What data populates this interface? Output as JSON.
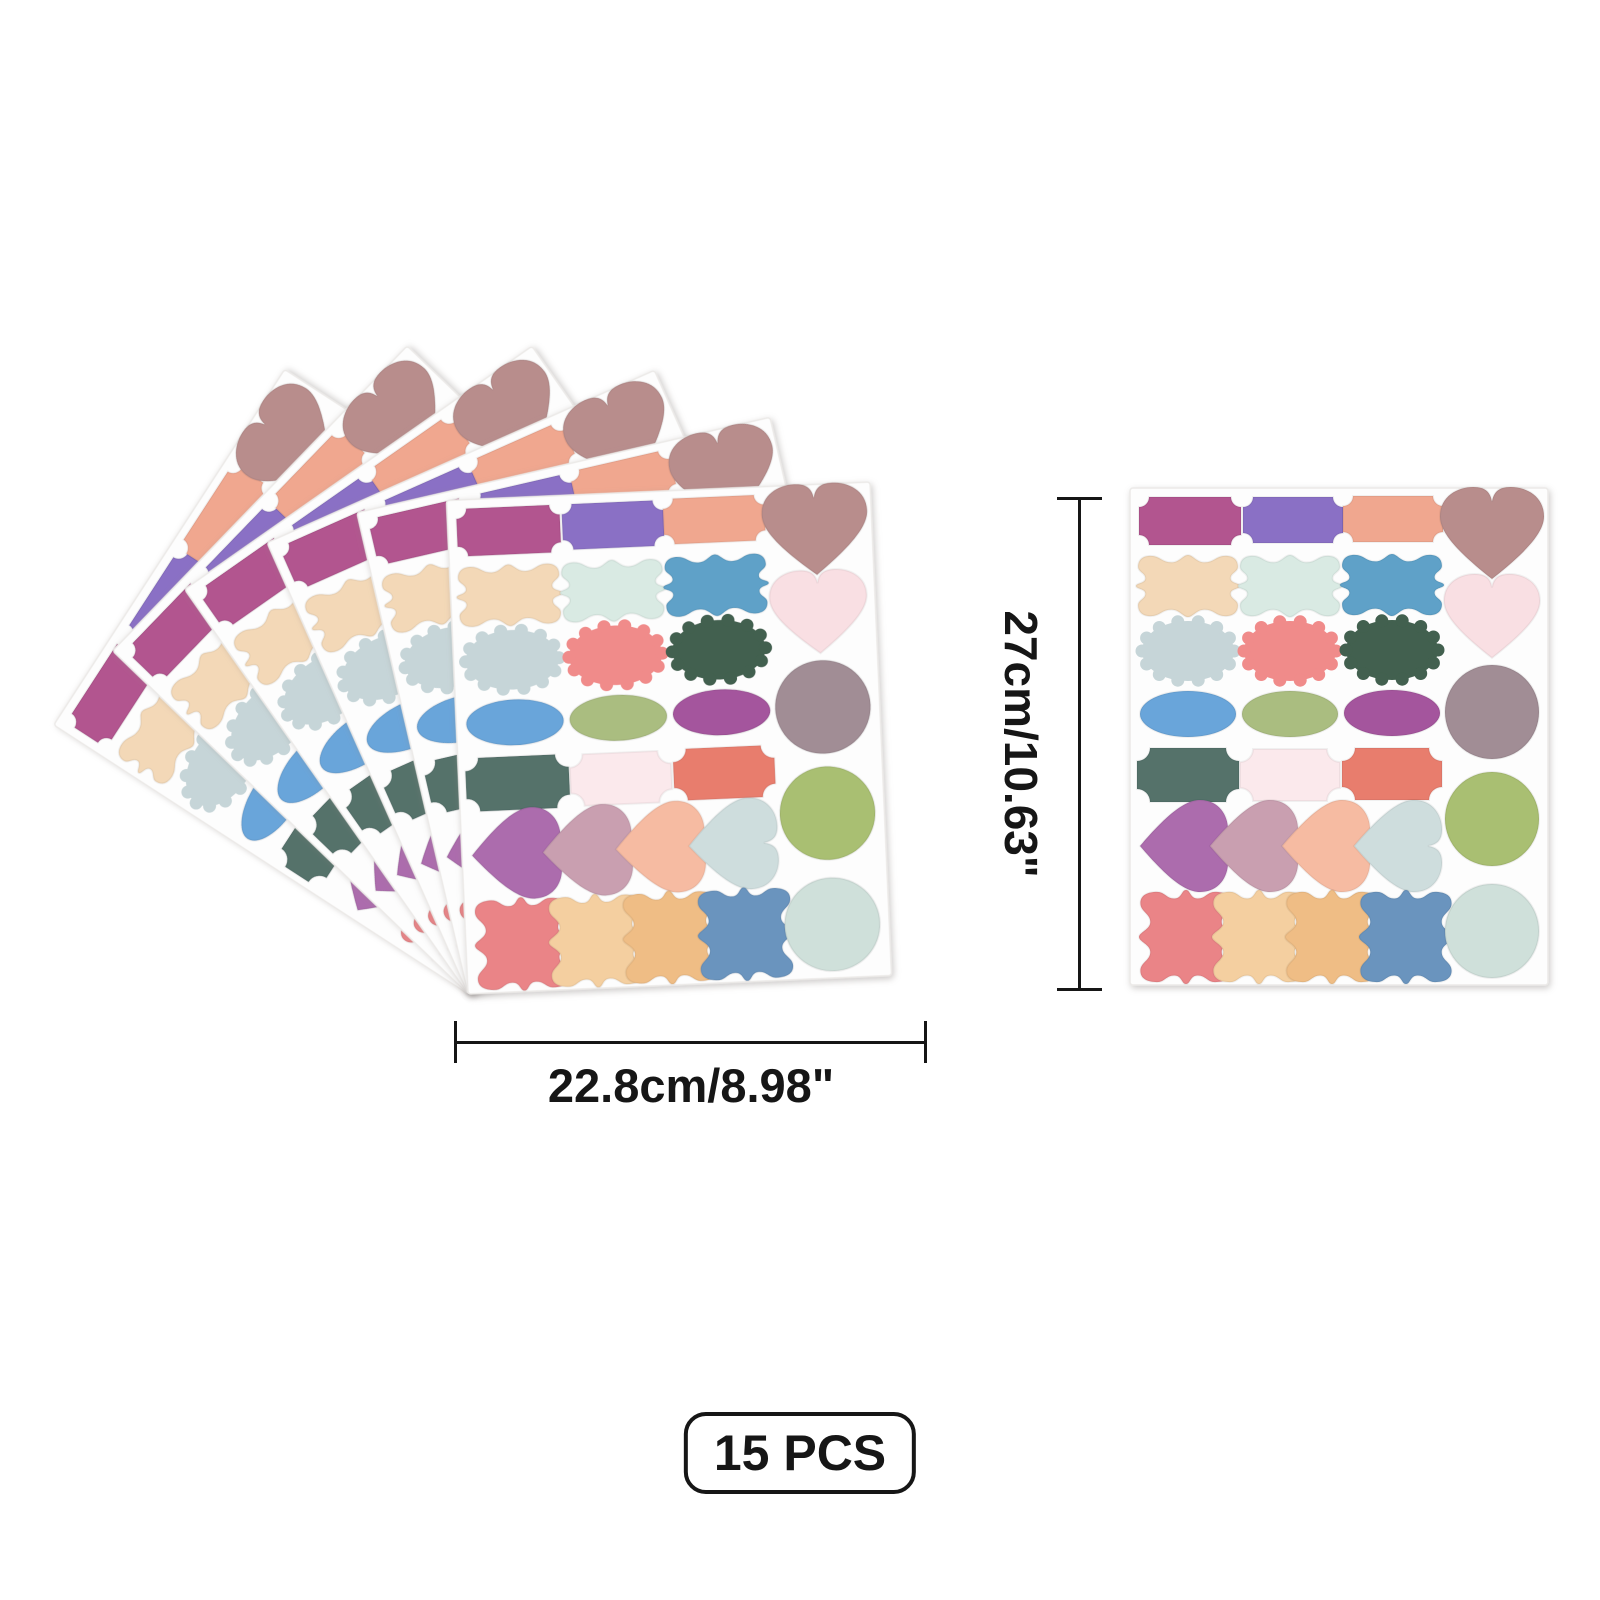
{
  "image": {
    "background": "#ffffff"
  },
  "product": {
    "kind": "pastel label sticker sheets",
    "sheet": {
      "w": 418,
      "h": 497,
      "bg": "#fdfdfd",
      "edge": "#eceae8",
      "stickers": [
        {
          "shape": "ticket",
          "cx": 60,
          "cy": 33,
          "w": 102,
          "h": 48,
          "r": 10,
          "rot": 0,
          "color": "#b2548f"
        },
        {
          "shape": "ticket",
          "cx": 163,
          "cy": 32,
          "w": 100,
          "h": 46,
          "r": 10,
          "rot": 0,
          "color": "#8a70c5"
        },
        {
          "shape": "ticket",
          "cx": 263,
          "cy": 31,
          "w": 100,
          "h": 46,
          "r": 10,
          "rot": 0,
          "color": "#f0a78f"
        },
        {
          "shape": "heart",
          "cx": 362,
          "cy": 45,
          "w": 104,
          "h": 92,
          "rot": 0,
          "color": "#b88d8c"
        },
        {
          "shape": "ornate",
          "cx": 58,
          "cy": 98,
          "w": 104,
          "h": 62,
          "rot": 0,
          "color": "#f3d8b7"
        },
        {
          "shape": "ornate",
          "cx": 160,
          "cy": 98,
          "w": 104,
          "h": 62,
          "rot": 0,
          "color": "#d9eae3"
        },
        {
          "shape": "ornate",
          "cx": 262,
          "cy": 97,
          "w": 104,
          "h": 62,
          "rot": 0,
          "color": "#5ea1c8"
        },
        {
          "shape": "heart",
          "cx": 362,
          "cy": 128,
          "w": 96,
          "h": 84,
          "rot": 0,
          "color": "#f9dfe3"
        },
        {
          "shape": "scallop",
          "cx": 58,
          "cy": 163,
          "w": 92,
          "h": 60,
          "rot": 0,
          "color": "#c6d5d8"
        },
        {
          "shape": "scallop",
          "cx": 160,
          "cy": 163,
          "w": 92,
          "h": 60,
          "rot": 0,
          "color": "#f08b8a"
        },
        {
          "shape": "scallop",
          "cx": 262,
          "cy": 162,
          "w": 92,
          "h": 60,
          "rot": 0,
          "color": "#42604f"
        },
        {
          "shape": "circle",
          "cx": 362,
          "cy": 224,
          "w": 94,
          "h": 94,
          "rot": 0,
          "color": "#a18d95"
        },
        {
          "shape": "ellipse",
          "cx": 58,
          "cy": 226,
          "w": 96,
          "h": 46,
          "rot": 0,
          "color": "#69a5da"
        },
        {
          "shape": "ellipse",
          "cx": 160,
          "cy": 226,
          "w": 96,
          "h": 46,
          "rot": 0,
          "color": "#aabd80"
        },
        {
          "shape": "ellipse",
          "cx": 262,
          "cy": 225,
          "w": 96,
          "h": 46,
          "rot": 0,
          "color": "#a4559d"
        },
        {
          "shape": "ticket",
          "cx": 58,
          "cy": 287,
          "w": 102,
          "h": 54,
          "r": 13,
          "rot": 0,
          "color": "#54726b"
        },
        {
          "shape": "ticket",
          "cx": 160,
          "cy": 287,
          "w": 100,
          "h": 52,
          "r": 13,
          "rot": 0,
          "color": "#fbe9ec"
        },
        {
          "shape": "ticket",
          "cx": 262,
          "cy": 286,
          "w": 100,
          "h": 52,
          "r": 13,
          "rot": 0,
          "color": "#e87d6d"
        },
        {
          "shape": "circle",
          "cx": 362,
          "cy": 331,
          "w": 94,
          "h": 94,
          "rot": 0,
          "color": "#a9bf72"
        },
        {
          "shape": "heart",
          "cx": 54,
          "cy": 358,
          "w": 92,
          "h": 88,
          "rot": 90,
          "color": "#ac6cad"
        },
        {
          "shape": "heart",
          "cx": 124,
          "cy": 358,
          "w": 92,
          "h": 88,
          "rot": 90,
          "color": "#c99fb0"
        },
        {
          "shape": "heart",
          "cx": 196,
          "cy": 358,
          "w": 92,
          "h": 88,
          "rot": 90,
          "color": "#f6bba2"
        },
        {
          "shape": "heart",
          "cx": 268,
          "cy": 358,
          "w": 92,
          "h": 88,
          "rot": 90,
          "color": "#cedddd"
        },
        {
          "shape": "ornate",
          "cx": 56,
          "cy": 449,
          "w": 94,
          "h": 94,
          "rot": 90,
          "color": "#ea8487"
        },
        {
          "shape": "ornate",
          "cx": 129,
          "cy": 449,
          "w": 94,
          "h": 94,
          "rot": 90,
          "color": "#f4cfa0"
        },
        {
          "shape": "ornate",
          "cx": 202,
          "cy": 449,
          "w": 94,
          "h": 94,
          "rot": 90,
          "color": "#efbd85"
        },
        {
          "shape": "ornate",
          "cx": 276,
          "cy": 449,
          "w": 94,
          "h": 94,
          "rot": 90,
          "color": "#6a94be"
        },
        {
          "shape": "circle",
          "cx": 362,
          "cy": 443,
          "w": 94,
          "h": 94,
          "rot": 0,
          "color": "#cfe0da"
        }
      ]
    },
    "fan": {
      "origin_x": 468,
      "origin_y": 500,
      "sheet_w": 424,
      "sheet_h": 494,
      "pivot_x": 468,
      "pivot_y": 994,
      "angles": [
        -57,
        -46,
        -35,
        -24,
        -13,
        -2.5
      ]
    },
    "single": {
      "x": 1130,
      "y": 488
    }
  },
  "annotations": {
    "width": {
      "label": "22.8cm/8.98\""
    },
    "height": {
      "label": "27cm/10.63\""
    },
    "badge": {
      "label": "15 PCS"
    },
    "line_color": "#161616"
  }
}
